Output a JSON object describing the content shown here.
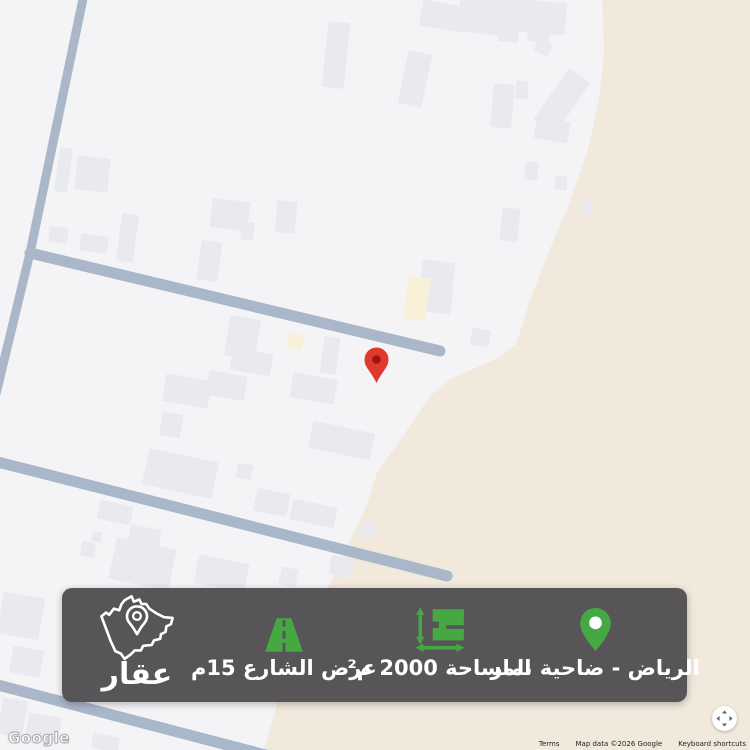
{
  "banner": {
    "brand": "عقار",
    "items": [
      {
        "id": "location",
        "label": "الرياض - ضاحية نمار"
      },
      {
        "id": "area",
        "label": "المساحة 2000 م²"
      },
      {
        "id": "street",
        "label": "عرض الشارع 15م"
      }
    ],
    "colors": {
      "background": "#575557",
      "accent": "#45A843",
      "text": "#FFFFFF"
    }
  },
  "map_overlay": {
    "google_logo": "Google",
    "attribution": {
      "terms": "Terms",
      "map_data": "Map data ©2026 Google",
      "keyboard_shortcuts": "Keyboard shortcuts"
    }
  },
  "map_data": {
    "colors": {
      "ground": "#f4f4f7",
      "desert": "#f0e9dc",
      "road": "#a9b7c9",
      "building": "#e8eaef",
      "cream": "#f8f1d7",
      "marker": "#df3a2d",
      "marker_dot": "#9d150d"
    },
    "marker": {
      "path": "M376.5 383 C371 371.5 364.5 367.3 364.5 359.5 A12 12 0 1 1 388.5 359.5 C388.5 367.3 382 371.5 376.5 383 Z",
      "dot": [
        376.5,
        359.5,
        4.3
      ]
    },
    "desert": [
      [
        602,
        -5
      ],
      [
        755,
        -5
      ],
      [
        755,
        755
      ],
      [
        262,
        755
      ],
      [
        280,
        695
      ],
      [
        300,
        648
      ],
      [
        322,
        600
      ],
      [
        345,
        552
      ],
      [
        368,
        502
      ],
      [
        377,
        473
      ],
      [
        403,
        436
      ],
      [
        430,
        396
      ],
      [
        452,
        378
      ],
      [
        473,
        369
      ],
      [
        500,
        357
      ],
      [
        516,
        344
      ],
      [
        531,
        298
      ],
      [
        549,
        251
      ],
      [
        568,
        207
      ],
      [
        588,
        149
      ],
      [
        599,
        99
      ],
      [
        604,
        54
      ]
    ],
    "roads": [
      {
        "name": "road-left-diagonal",
        "points": [
          [
            84,
            -6
          ],
          [
            30,
            253
          ],
          [
            -6,
            402
          ]
        ],
        "width": 9,
        "cap": "butt"
      },
      {
        "name": "road-upper-cross",
        "points": [
          [
            30,
            253
          ],
          [
            440,
            351
          ]
        ],
        "width": 11,
        "cap": "round"
      },
      {
        "name": "road-middle-cross",
        "points": [
          [
            -6,
            461
          ],
          [
            447,
            576
          ]
        ],
        "width": 11,
        "cap": "round"
      },
      {
        "name": "road-bottom-diagonal",
        "points": [
          [
            -6,
            684
          ],
          [
            300,
            764
          ]
        ],
        "width": 11,
        "cap": "butt"
      }
    ],
    "buildings": [
      {
        "x": 57,
        "y": 148,
        "w": 13,
        "h": 44,
        "r": 8
      },
      {
        "x": 76,
        "y": 157,
        "w": 33,
        "h": 34,
        "r": 6
      },
      {
        "x": 119,
        "y": 214,
        "w": 17,
        "h": 48,
        "r": 8
      },
      {
        "x": 49,
        "y": 227,
        "w": 19,
        "h": 16,
        "r": 8
      },
      {
        "x": 80,
        "y": 235,
        "w": 28,
        "h": 17,
        "r": 8
      },
      {
        "x": 211,
        "y": 200,
        "w": 38,
        "h": 29,
        "r": 6
      },
      {
        "x": 241,
        "y": 222,
        "w": 13,
        "h": 18,
        "r": 6
      },
      {
        "x": 276,
        "y": 201,
        "w": 20,
        "h": 32,
        "r": 6
      },
      {
        "x": 199,
        "y": 241,
        "w": 21,
        "h": 40,
        "r": 8
      },
      {
        "x": 325,
        "y": 22,
        "w": 22,
        "h": 66,
        "r": 6
      },
      {
        "x": 421,
        "y": 3,
        "w": 42,
        "h": 26,
        "r": 10
      },
      {
        "x": 458,
        "y": 0,
        "w": 52,
        "h": 34,
        "r": 8
      },
      {
        "x": 488,
        "y": 0,
        "w": 78,
        "h": 32,
        "r": 5
      },
      {
        "x": 498,
        "y": 30,
        "w": 20,
        "h": 12,
        "r": 8
      },
      {
        "x": 528,
        "y": 26,
        "w": 22,
        "h": 16,
        "r": 8
      },
      {
        "x": 536,
        "y": 40,
        "w": 15,
        "h": 14,
        "r": 30
      },
      {
        "x": 403,
        "y": 52,
        "w": 24,
        "h": 54,
        "r": 12
      },
      {
        "x": 492,
        "y": 84,
        "w": 21,
        "h": 44,
        "r": 5
      },
      {
        "x": 516,
        "y": 81,
        "w": 12,
        "h": 18,
        "r": 5
      },
      {
        "x": 549,
        "y": 70,
        "w": 26,
        "h": 62,
        "r": 35
      },
      {
        "x": 535,
        "y": 119,
        "w": 34,
        "h": 22,
        "r": 10
      },
      {
        "x": 525,
        "y": 162,
        "w": 13,
        "h": 18,
        "r": 6
      },
      {
        "x": 555,
        "y": 176,
        "w": 12,
        "h": 14,
        "r": 6
      },
      {
        "x": 501,
        "y": 208,
        "w": 18,
        "h": 33,
        "r": 6
      },
      {
        "x": 580,
        "y": 201,
        "w": 12,
        "h": 12,
        "r": 6
      },
      {
        "x": 421,
        "y": 261,
        "w": 33,
        "h": 28,
        "r": 8
      },
      {
        "x": 423,
        "y": 286,
        "w": 29,
        "h": 27,
        "r": 8
      },
      {
        "x": 406,
        "y": 277,
        "w": 22,
        "h": 43,
        "r": 8,
        "c": "cream"
      },
      {
        "x": 471,
        "y": 329,
        "w": 19,
        "h": 17,
        "r": 8
      },
      {
        "x": 227,
        "y": 317,
        "w": 31,
        "h": 41,
        "r": 10
      },
      {
        "x": 231,
        "y": 351,
        "w": 41,
        "h": 22,
        "r": 10
      },
      {
        "x": 288,
        "y": 334,
        "w": 15,
        "h": 15,
        "r": 8,
        "c": "cream"
      },
      {
        "x": 322,
        "y": 337,
        "w": 16,
        "h": 37,
        "r": 8
      },
      {
        "x": 164,
        "y": 377,
        "w": 46,
        "h": 28,
        "r": 10
      },
      {
        "x": 207,
        "y": 373,
        "w": 39,
        "h": 25,
        "r": 10
      },
      {
        "x": 161,
        "y": 413,
        "w": 21,
        "h": 24,
        "r": 10
      },
      {
        "x": 145,
        "y": 455,
        "w": 71,
        "h": 37,
        "r": 12
      },
      {
        "x": 291,
        "y": 376,
        "w": 45,
        "h": 25,
        "r": 10
      },
      {
        "x": 310,
        "y": 427,
        "w": 63,
        "h": 27,
        "r": 12
      },
      {
        "x": 237,
        "y": 464,
        "w": 15,
        "h": 15,
        "r": 10
      },
      {
        "x": 255,
        "y": 491,
        "w": 34,
        "h": 23,
        "r": 12
      },
      {
        "x": 291,
        "y": 503,
        "w": 45,
        "h": 21,
        "r": 12
      },
      {
        "x": 360,
        "y": 523,
        "w": 15,
        "h": 14,
        "r": 12
      },
      {
        "x": 98,
        "y": 503,
        "w": 34,
        "h": 19,
        "r": 12
      },
      {
        "x": 81,
        "y": 542,
        "w": 14,
        "h": 15,
        "r": 10
      },
      {
        "x": 92,
        "y": 532,
        "w": 10,
        "h": 10,
        "r": 10
      },
      {
        "x": 112,
        "y": 543,
        "w": 61,
        "h": 42,
        "r": 12
      },
      {
        "x": 129,
        "y": 527,
        "w": 31,
        "h": 21,
        "r": 12
      },
      {
        "x": 196,
        "y": 559,
        "w": 51,
        "h": 29,
        "r": 12
      },
      {
        "x": 280,
        "y": 568,
        "w": 17,
        "h": 18,
        "r": 12
      },
      {
        "x": 330,
        "y": 557,
        "w": 23,
        "h": 19,
        "r": 12
      },
      {
        "x": 0,
        "y": 595,
        "w": 42,
        "h": 42,
        "r": 10
      },
      {
        "x": 11,
        "y": 648,
        "w": 31,
        "h": 27,
        "r": 10
      },
      {
        "x": 27,
        "y": 715,
        "w": 33,
        "h": 25,
        "r": 10
      },
      {
        "x": 92,
        "y": 735,
        "w": 27,
        "h": 15,
        "r": 10
      },
      {
        "x": 0,
        "y": 699,
        "w": 25,
        "h": 37,
        "r": 10
      }
    ]
  }
}
